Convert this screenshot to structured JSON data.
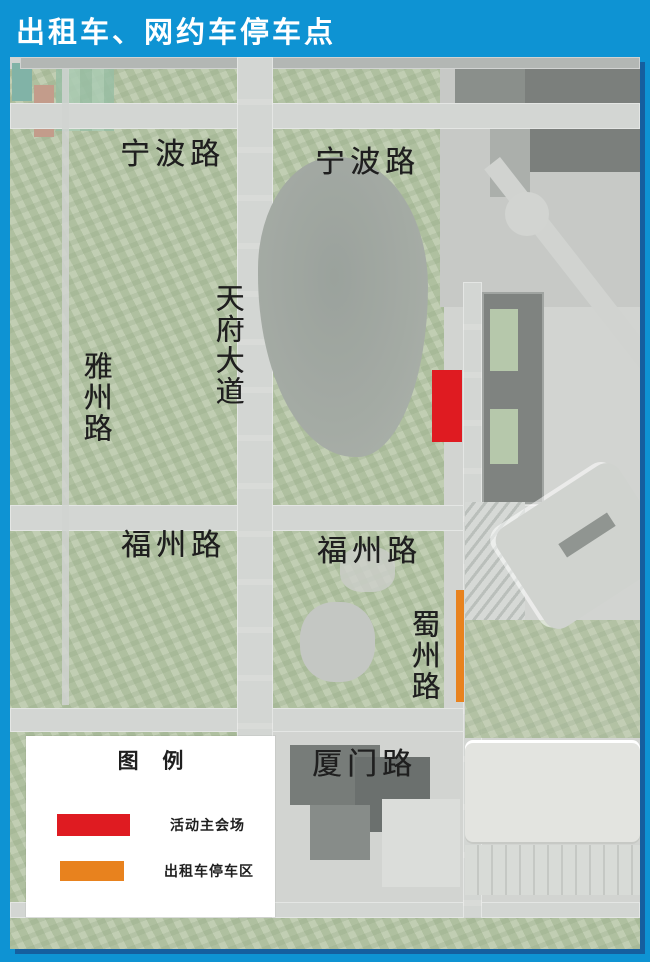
{
  "header": {
    "title": "出租车、网约车停车点",
    "bg_color": "#0e93d3",
    "text_color": "#ffffff"
  },
  "map": {
    "type": "satellite-map",
    "road_labels": [
      {
        "id": "ningbo-left",
        "text": "宁波路",
        "orientation": "horizontal"
      },
      {
        "id": "ningbo-right",
        "text": "宁波路",
        "orientation": "horizontal"
      },
      {
        "id": "tianfu-avenue",
        "text": "天府大道",
        "orientation": "vertical"
      },
      {
        "id": "yazhou-road",
        "text": "雅州路",
        "orientation": "vertical"
      },
      {
        "id": "fuzhou-left",
        "text": "福州路",
        "orientation": "horizontal"
      },
      {
        "id": "fuzhou-right",
        "text": "福州路",
        "orientation": "horizontal"
      },
      {
        "id": "shuzhou-road",
        "text": "蜀州路",
        "orientation": "vertical"
      },
      {
        "id": "xiamen-road",
        "text": "厦门路",
        "orientation": "horizontal"
      }
    ],
    "markers": [
      {
        "id": "main-venue",
        "shape": "rectangle",
        "color": "#df1b21",
        "meaning": "活动主会场"
      },
      {
        "id": "taxi-parking",
        "shape": "bar",
        "color": "#e8821e",
        "meaning": "出租车停车区"
      }
    ]
  },
  "legend": {
    "title": "图 例",
    "items": [
      {
        "label": "活动主会场",
        "color": "#df1b21"
      },
      {
        "label": "出租车停车区",
        "color": "#e8821e"
      }
    ]
  }
}
